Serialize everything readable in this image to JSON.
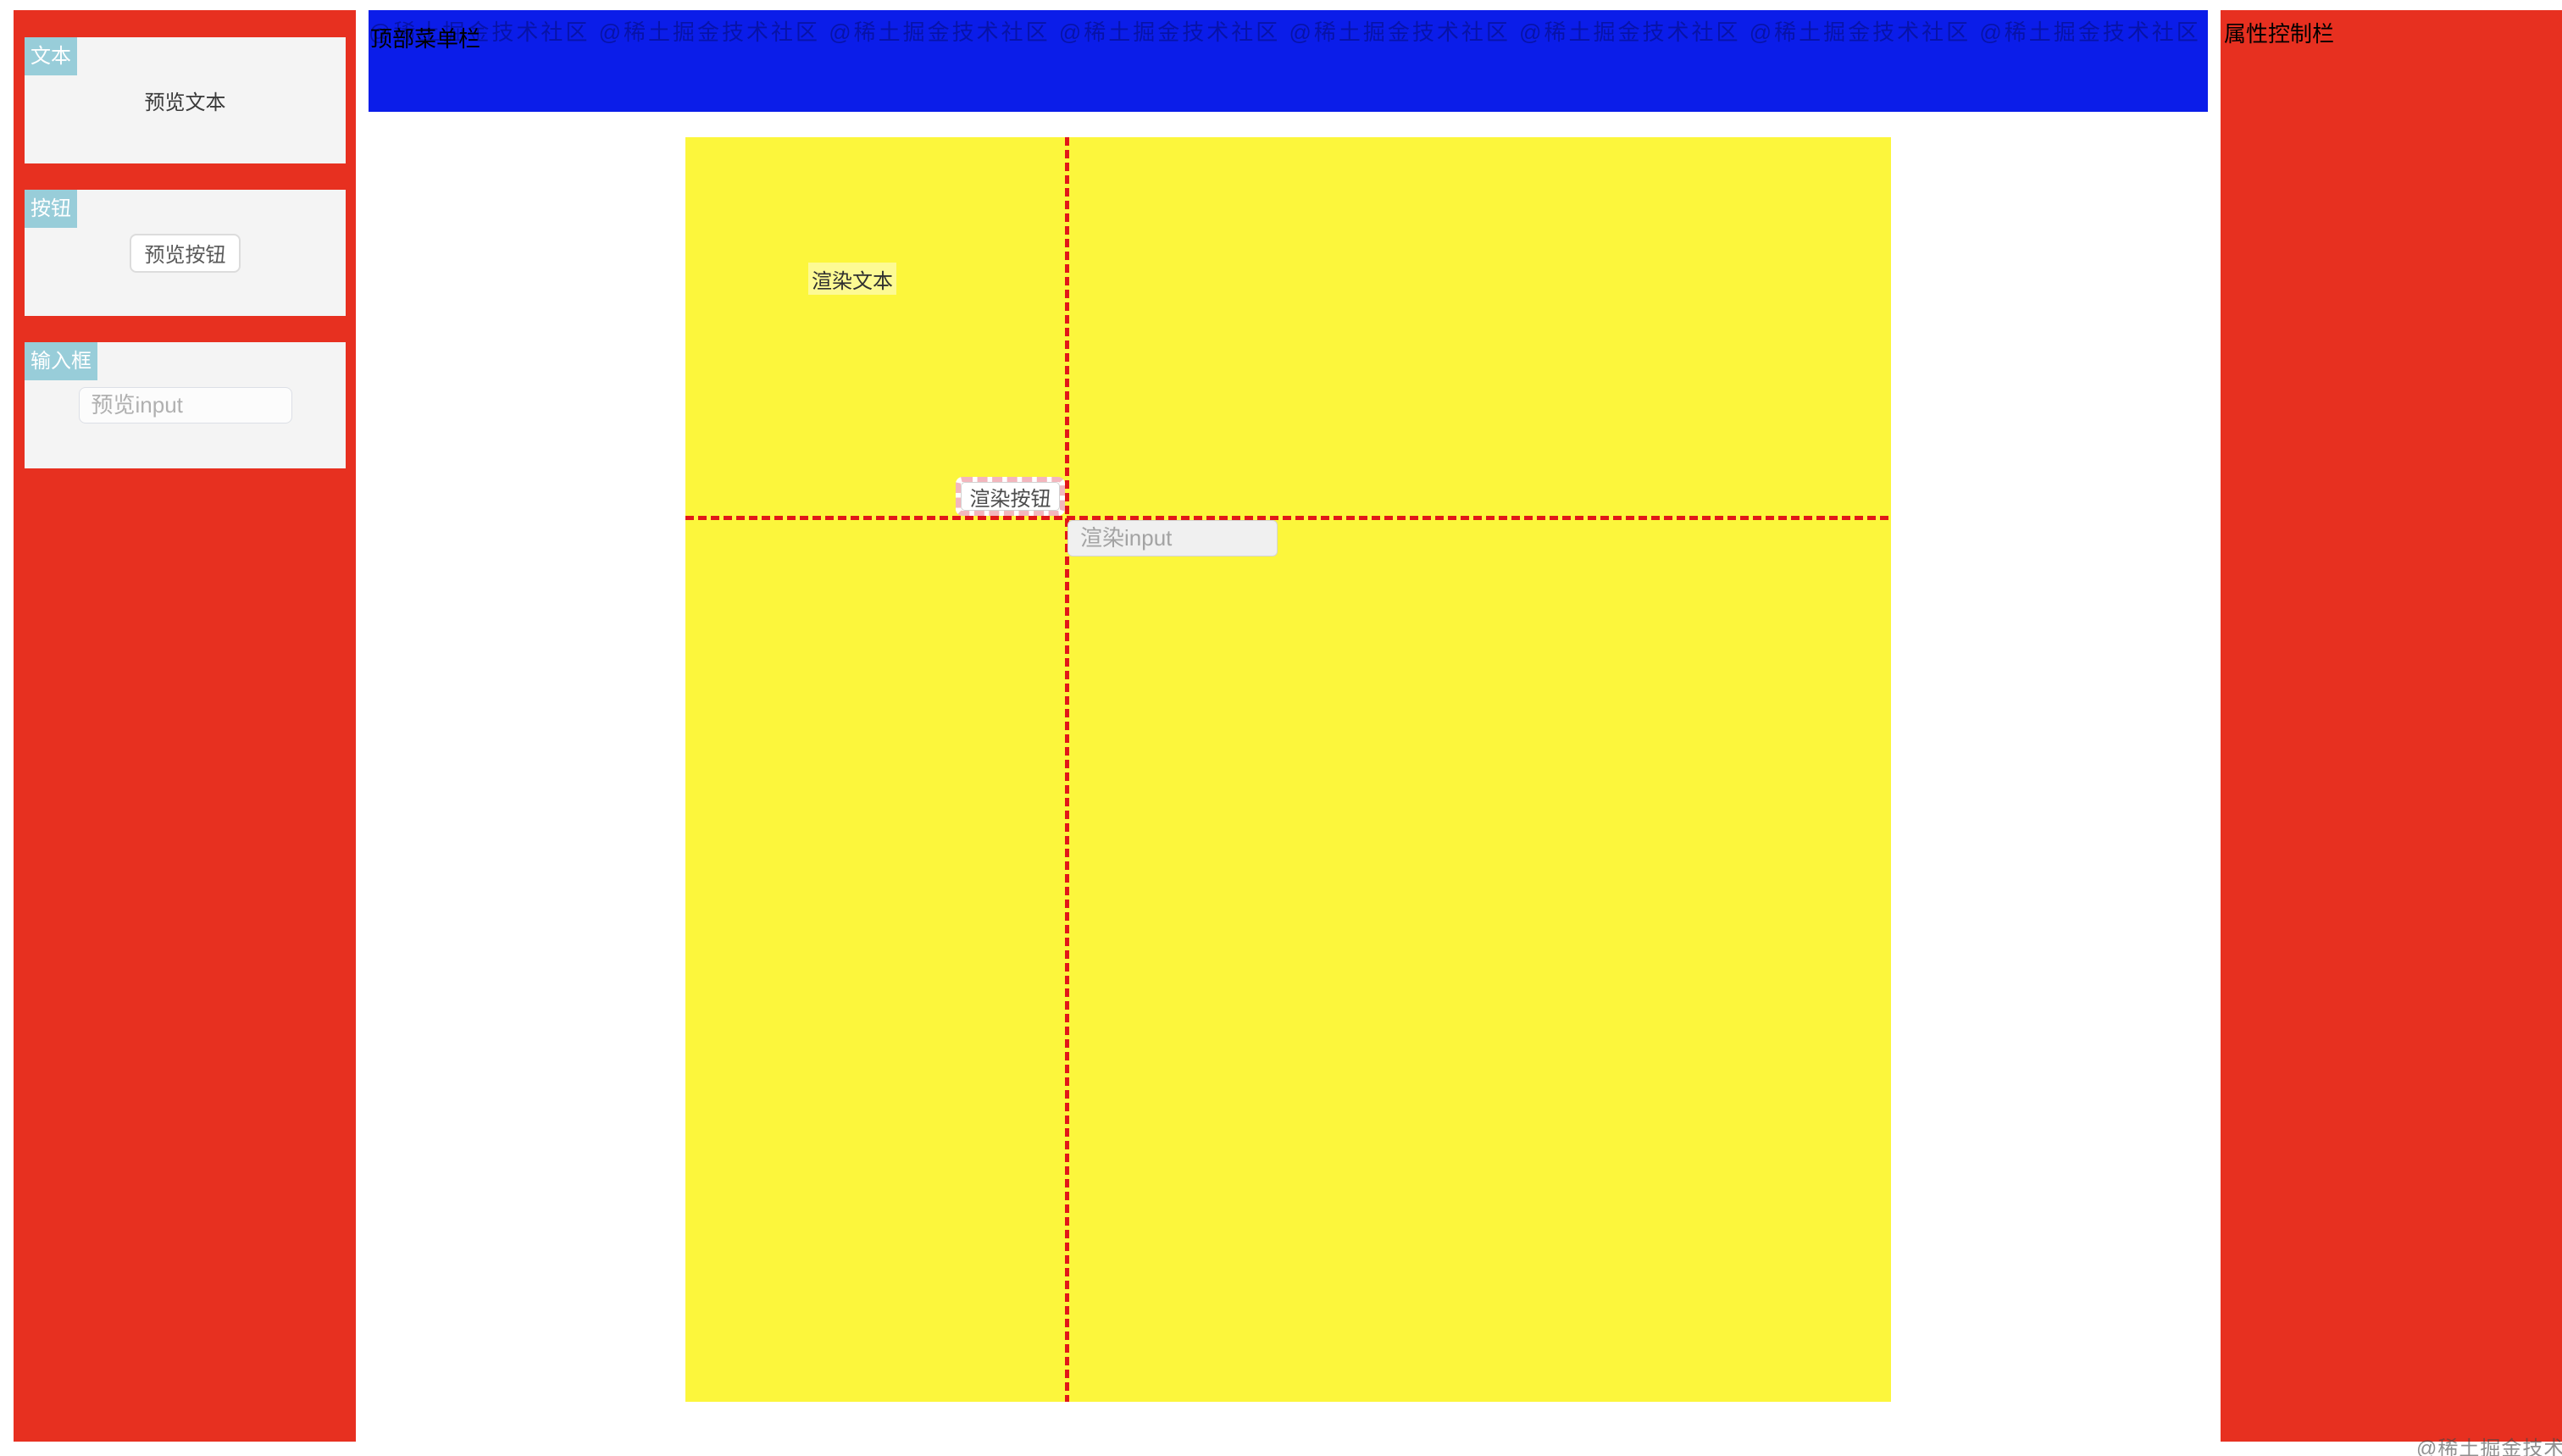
{
  "top_menubar": {
    "label": "顶部菜单栏"
  },
  "right_panel": {
    "title": "属性控制栏"
  },
  "left_panel": {
    "cards": [
      {
        "badge": "文本",
        "preview_label": "预览文本"
      },
      {
        "badge": "按钮",
        "preview_label": "预览按钮"
      },
      {
        "badge": "输入框",
        "preview_placeholder": "预览input"
      }
    ]
  },
  "canvas": {
    "text_label": "渲染文本",
    "button_label": "渲染按钮",
    "input_placeholder": "渲染input"
  },
  "watermark": {
    "stamp": "@稀土掘金技术社区"
  },
  "colors": {
    "panel_red": "#e73020",
    "menubar_blue": "#0b1de9",
    "canvas_yellow": "#fcf63c",
    "badge_teal": "#98cdd9",
    "guide_line_red": "#e11818",
    "drag_ghost_pink": "#f3b6bd"
  }
}
